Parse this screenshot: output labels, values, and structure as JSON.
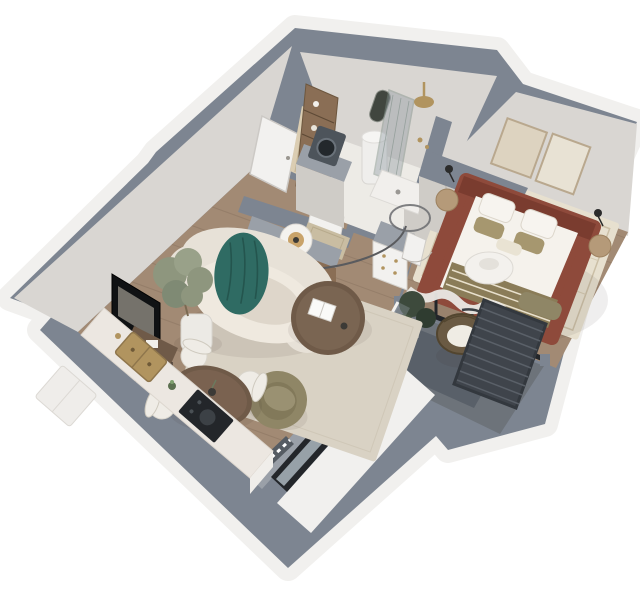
{
  "meta": {
    "description": "3D isometric render of a one-bedroom apartment floor plan viewed from above, white background",
    "view": "axonometric top-down",
    "canvas": {
      "width": 640,
      "height": 610
    }
  },
  "palette": {
    "wall_top": "#7d8591",
    "wall_top_light": "#9aa0a8",
    "wall_outer": "#f1f0ee",
    "wall_inner": "#d9d6d2",
    "wall_inner2": "#cfccc7",
    "floor_wood": "#a28a74",
    "plank": "#86705e",
    "floor_tile": "#edebe6",
    "floor_balcony": "#6d737a",
    "balcony_mat": "#596069",
    "rug": "#d9d2c4",
    "rug2": "#e7e0cf",
    "sofa": "#e7e1d7",
    "sofa_shade": "#d4cdbf",
    "teal": "#2f6b63",
    "teal_dark": "#24554e",
    "wood_dark": "#6f5a48",
    "wood_mid": "#8a6e55",
    "wood_light": "#b59a79",
    "chair": "#efece6",
    "olive": "#8f8666",
    "olive_dark": "#7c7355",
    "bed": "#8e4a3b",
    "bed_dark": "#7a3c2f",
    "linen": "#f5f2ec",
    "blanket": "#8a7c58",
    "pillow_olive": "#a6976f",
    "green": "#8e967e",
    "green_dark": "#3d4a3c",
    "pot": "#eceae5",
    "marble": "#ece7e1",
    "black": "#23262a",
    "glass": "#97a1a8",
    "brass": "#b1945f",
    "white_door": "#f2f1ef",
    "radiator": "#dbcdb2",
    "washer": "#4d545b",
    "grate": "#3f444b",
    "grate_rib": "#5a6068",
    "curtain": "#eae8e4"
  },
  "scene": {
    "rooms": [
      {
        "name": "entry-hall",
        "items": [
          "front-door",
          "vertical-radiator",
          "storage-shelf",
          "coat-cabinet",
          "doormat"
        ]
      },
      {
        "name": "bathroom",
        "items": [
          "vanity-unit",
          "washing-machine",
          "water-heater",
          "arched-mirror",
          "walk-in-shower",
          "rain-shower-head",
          "shower-tray",
          "glass-screen"
        ]
      },
      {
        "name": "living-room",
        "items": [
          "curved-boucle-sofa",
          "teal-throw",
          "round-coffee-table",
          "book",
          "drum-floor-lamp",
          "arc-lamp",
          "open-sideboard",
          "olive-armchair",
          "area-rug",
          "olive-tree",
          "wall-tv",
          "console-table"
        ]
      },
      {
        "name": "dining-area",
        "items": [
          "round-dining-table",
          "dining-chair",
          "dining-chair",
          "dining-chair",
          "dining-chair",
          "vase"
        ]
      },
      {
        "name": "kitchen",
        "items": [
          "counter-run",
          "marble-worktop",
          "brass-sink",
          "black-cooktop",
          "tall-cabinet"
        ]
      },
      {
        "name": "bedroom",
        "items": [
          "terracotta-double-bed",
          "white-duvet",
          "pillows",
          "striped-olive-blanket",
          "nightstand",
          "nightstand",
          "wall-lamp",
          "wall-lamp",
          "wall-art",
          "wall-art",
          "grey-wardrobe",
          "dresser",
          "foot-bench",
          "paper-pendant-lamp",
          "cream-rug",
          "sheer-curtains",
          "bedroom-door"
        ]
      },
      {
        "name": "balcony",
        "items": [
          "rattan-hanging-chair",
          "monstera-plants",
          "glass-railing",
          "black-framed-glass-doors",
          "dark-decking"
        ]
      },
      {
        "name": "service-shaft",
        "items": [
          "ventilation-grate"
        ]
      },
      {
        "name": "facade",
        "items": [
          "black-framed-window",
          "black-framed-window",
          "threshold-strip"
        ]
      }
    ]
  }
}
